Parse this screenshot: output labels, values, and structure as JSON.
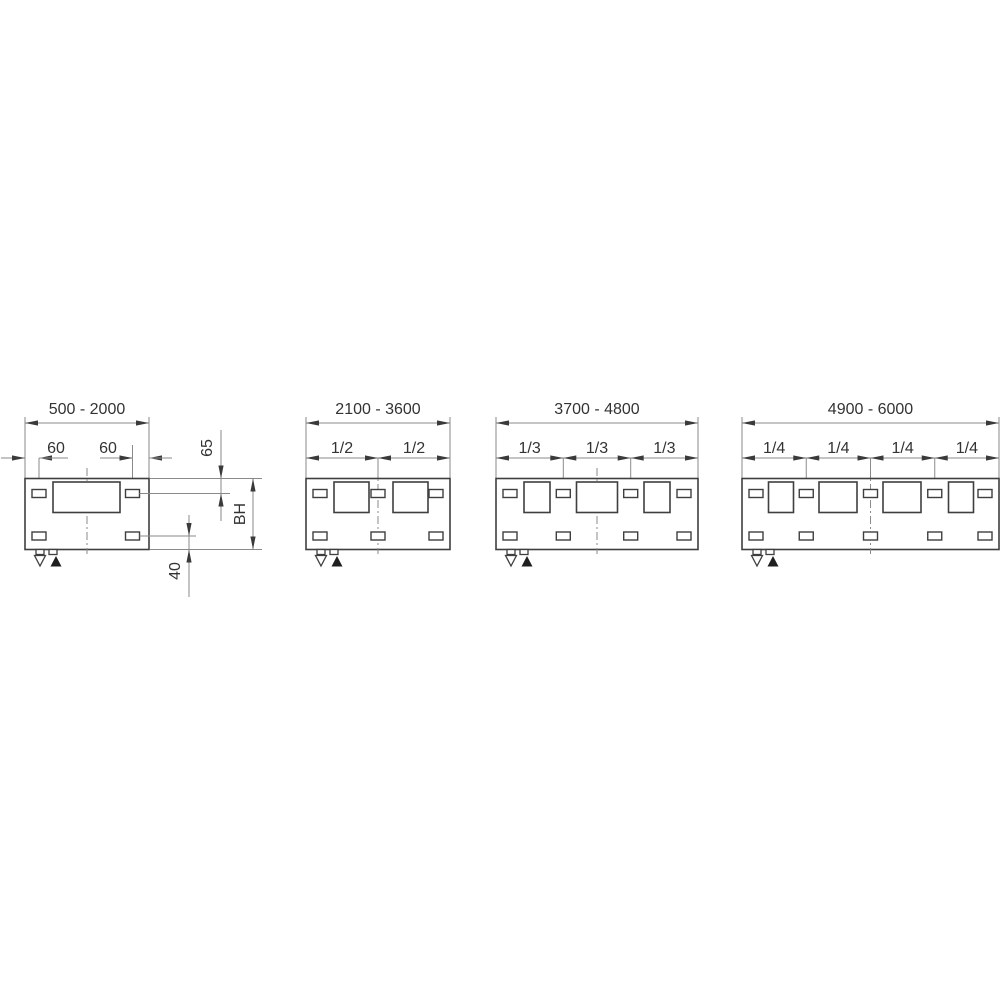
{
  "drawing": {
    "description_labels": {
      "panel_count": "4"
    },
    "panels": [
      {
        "range_label": "500 - 2000",
        "bracket_offset_labels": [
          "60",
          "60"
        ],
        "segment_labels": [],
        "symbols": [
          "▽",
          "▲"
        ]
      },
      {
        "range_label": "2100 - 3600",
        "bracket_offset_labels": [],
        "segment_labels": [
          "1/2",
          "1/2"
        ],
        "symbols": [
          "▽",
          "▲"
        ]
      },
      {
        "range_label": "3700 - 4800",
        "bracket_offset_labels": [],
        "segment_labels": [
          "1/3",
          "1/3",
          "1/3"
        ],
        "symbols": [
          "▽",
          "▲"
        ]
      },
      {
        "range_label": "4900 - 6000",
        "bracket_offset_labels": [],
        "segment_labels": [
          "1/4",
          "1/4",
          "1/4",
          "1/4"
        ],
        "symbols": [
          "▽",
          "▲"
        ]
      }
    ],
    "vertical_dims": {
      "top_bracket_offset": "65",
      "build_height": "BH",
      "bottom_bracket_offset": "40"
    }
  },
  "colors": {
    "background": "#ffffff",
    "outline": "#3f3f3f",
    "dimension": "#8a8a8a",
    "arrow": "#3a3a3a",
    "text": "#333333",
    "filled_triangle": "#1f1f1f"
  },
  "layout": {
    "rect_top": 478.5,
    "rect_bottom": 549.5,
    "dim_line_y": 423,
    "range_label_y": 414,
    "seg_dim_y": 458,
    "seg_label_y": 453,
    "ext_top_y": 417,
    "square_top": 482,
    "square_h": 30.5,
    "bracket_w": 14,
    "bracket_h": 8,
    "bracket_row_top_cy": 493.5,
    "bracket_row_bottom_cy": 536,
    "centerline_top": 468,
    "centerline_bottom": 554,
    "tab_offsets": [
      11,
      24
    ],
    "tab_w": 8,
    "tab_h": 5,
    "tri_down_cx_off": 15,
    "tri_up_cx_off": 31,
    "tri_half_w": 5.5,
    "tri_top_y": 555.5,
    "tri_bot_y": 566.5,
    "panels": [
      {
        "x": 25,
        "w": 124,
        "brackets": [
          14,
          107.5
        ],
        "squares": [
          {
            "x": 28,
            "w": 67
          }
        ]
      },
      {
        "x": 306,
        "w": 144,
        "brackets": [
          14,
          72,
          130
        ],
        "squares": [
          {
            "x": 28,
            "w": 35
          },
          {
            "x": 87,
            "w": 35
          }
        ]
      },
      {
        "x": 496,
        "w": 202,
        "brackets": [
          14,
          67.3,
          134.7,
          188
        ],
        "squares": [
          {
            "x": 28,
            "w": 26
          },
          {
            "x": 80.5,
            "w": 41
          },
          {
            "x": 148,
            "w": 26
          }
        ]
      },
      {
        "x": 742,
        "w": 257,
        "brackets": [
          14,
          64.25,
          128.5,
          192.75,
          243
        ],
        "squares": [
          {
            "x": 26.5,
            "w": 25
          },
          {
            "x": 77,
            "w": 38
          },
          {
            "x": 141,
            "w": 38
          },
          {
            "x": 206.5,
            "w": 25
          }
        ]
      }
    ],
    "p1": {
      "edge_arrow_left_start": 1,
      "left_tick_x": 39,
      "left_tick_top": 458,
      "right_tick_x": 132.5,
      "right_tick_top": 445,
      "label60_left_x": 56,
      "label60_right_x": 108,
      "dim65_x": 221,
      "dim65_line_top": 430,
      "dim65_line_bot": 521,
      "dimBH_x": 253,
      "dim40_x": 189,
      "dim40_line_top": 515,
      "dim40_line_bot": 597,
      "ext_top_edge": [
        150,
        262
      ],
      "ext_top_bracket": [
        139.5,
        230
      ],
      "ext_bottom_bracket": [
        139.5,
        196
      ],
      "ext_bottom_edge": [
        150,
        262
      ],
      "rot_label_65": [
        212,
        448
      ],
      "rot_label_BH": [
        245,
        514
      ],
      "rot_label_40": [
        180,
        571
      ]
    }
  }
}
